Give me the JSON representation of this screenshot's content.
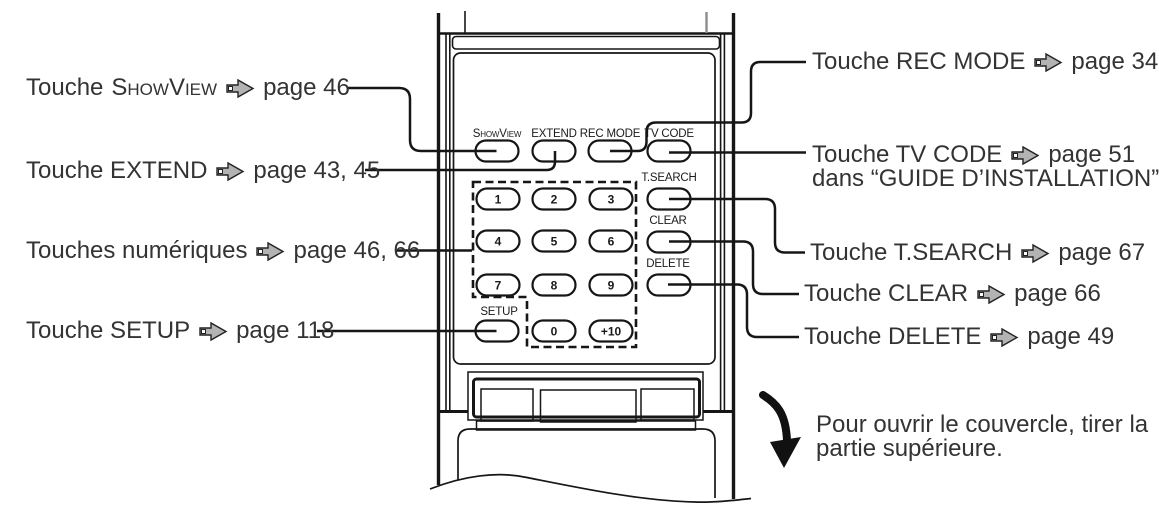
{
  "figure": {
    "description_for_template_only": "remote control diagram",
    "colors": {
      "line": "#161616",
      "arrow_fill": "#b3b3b3",
      "text": "#333333",
      "gray_tick": "#8d8d8d"
    }
  },
  "labels": {
    "showview": {
      "prefix": "Touche",
      "keyword": "ShowView",
      "page": "page 46"
    },
    "extend": {
      "prefix": "Touche EXTEND",
      "page": "page 43, 45"
    },
    "numeric": {
      "prefix": "Touches numériques",
      "page": "page 46, 66"
    },
    "setup": {
      "prefix": "Touche SETUP",
      "page": "page 118"
    },
    "recmode": {
      "prefix": "Touche REC MODE",
      "page": "page 34"
    },
    "tvcode": {
      "prefix": "Touche TV CODE",
      "page": "page 51",
      "line2": "dans “GUIDE D’INSTALLATION”"
    },
    "tsearch": {
      "prefix": "Touche T.SEARCH",
      "page": "page 67"
    },
    "clear": {
      "prefix": "Touche CLEAR",
      "page": "page 66"
    },
    "delete": {
      "prefix": "Touche DELETE",
      "page": "page 49"
    }
  },
  "note": {
    "line1": "Pour ouvrir le couvercle, tirer la",
    "line2": "partie supérieure."
  },
  "remote": {
    "buttons": {
      "showview": "ShowView",
      "extend": "EXTEND",
      "recmode": "REC MODE",
      "tvcode": "TV CODE",
      "tsearch": "T.SEARCH",
      "clear": "CLEAR",
      "delete": "DELETE",
      "setup": "SETUP"
    },
    "digits": [
      "1",
      "2",
      "3",
      "4",
      "5",
      "6",
      "7",
      "8",
      "9",
      "0",
      "+10"
    ]
  }
}
